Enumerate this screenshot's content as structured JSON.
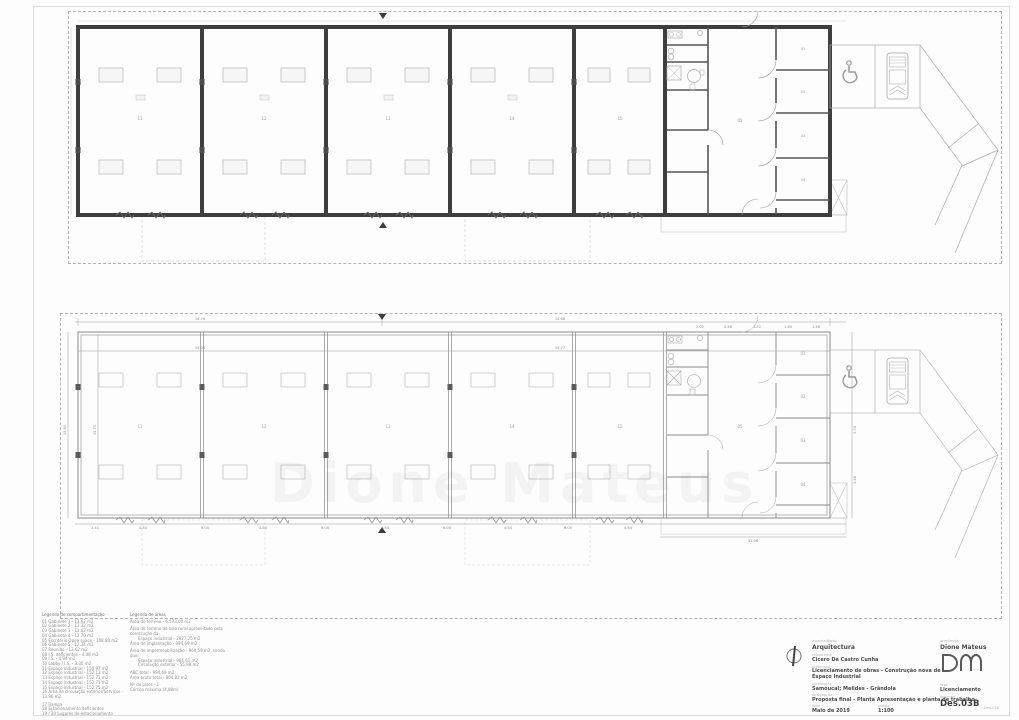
{
  "sheet": {
    "corner_stamp": "Des.03B"
  },
  "watermark": "Dione Mateus",
  "legend": {
    "left": {
      "header": "Legenda de compartimentação",
      "items": [
        "01 Gabinete 1 - 13.62 m2",
        "02 Gabinete 2 - 13.32 m2",
        "03 Gabinete 3 - 13.02 m2",
        "04 Gabinete 4 - 12.70 m2",
        "05 Escritório Open space - 108.80 m2",
        "06 Gabinete 5 - 12.34 m2",
        "07 Reunião - 13.62 m2",
        "08 I.S. deficientes - 4.08 m2",
        "09 I.S. - 4.94 m2",
        "10 Lobby / I.S. - 3.30 m2",
        "11 Espaço industrial - 150.97 m2",
        "12 Espaço industrial - 152.13 m2",
        "13 Espaço industrial - 152.71 m2",
        "14 Espaço industrial - 152.71 m2",
        "15 Espaço industrial - 152.75 m2",
        "16 Área de circulação exterior/Serviços - 13.96 m2",
        "17 Rampa",
        "18 Estacionamento deficientes",
        "19 / 20 Lugares de estacionamento"
      ]
    },
    "right": {
      "header": "Legenda de áreas",
      "items": [
        "Área do terreno - 6.573,00 m2",
        "Área de terreno de solo rural aproveitado pela construção da",
        "Espaço industrial - 2927,25 m2",
        "Área de implantação - 994,69 m2",
        "Área de impermeabilização - 960,59 m2, sendo que:",
        "Espaço industrial - 904,61 m2",
        "Circulação exterior - 55,98 m2",
        "ABC total - 994,69 m2",
        "Área bruta total - 904,82 m2",
        "Nº de pisos - 1",
        "Cércea máxima (4,88m)"
      ]
    }
  },
  "titleblock": {
    "especialidade_label": "especialidade",
    "especialidade": "Arquitectura",
    "requerente_label": "requerente",
    "requerente": "Cicero De Castro Cunha",
    "pretensao_label": "pretensão",
    "pretensao": "Licenciamento de obras - Construção nova de Espaço Industrial",
    "localizacao_label": "localização",
    "localizacao": "Samoucal; Melides - Grândola",
    "designacao_label": "designação",
    "designacao": "Proposta final - Planta Apresentação e planta de trabalho",
    "data_label": "data",
    "data": "Maio de 2019",
    "escala_label": "escala",
    "escala": "1:100",
    "arquitecta_label": "arquitecta",
    "arquitecta": "Dione Mateus",
    "logo": "DM",
    "fase_label": "fase",
    "fase": "Licenciamento",
    "desenho_label": "desenho",
    "desenho": "Des.03B"
  },
  "plans": {
    "room_labels": {
      "bays": [
        "11",
        "12",
        "13",
        "14",
        "15"
      ],
      "offices": [
        "01",
        "02",
        "03",
        "04"
      ],
      "open_space": "05"
    },
    "dims": {
      "top_a": "14.76",
      "top_b": "14.66",
      "inner_a": "14.05",
      "inner_b": "14.77",
      "left_a": "15.40",
      "left_b": "15.70",
      "wing_top": [
        "2.02",
        "2.48",
        "1.52",
        "1.60",
        "1.48"
      ],
      "bottom_chain": [
        "3.41",
        "4.84",
        "6.00",
        "4.84",
        "6.00",
        "4.84",
        "6.00",
        "4.84",
        "6.00",
        "4.84"
      ],
      "wing_total": "31.08",
      "right_a": "1.48",
      "right_b": "3.30"
    }
  }
}
